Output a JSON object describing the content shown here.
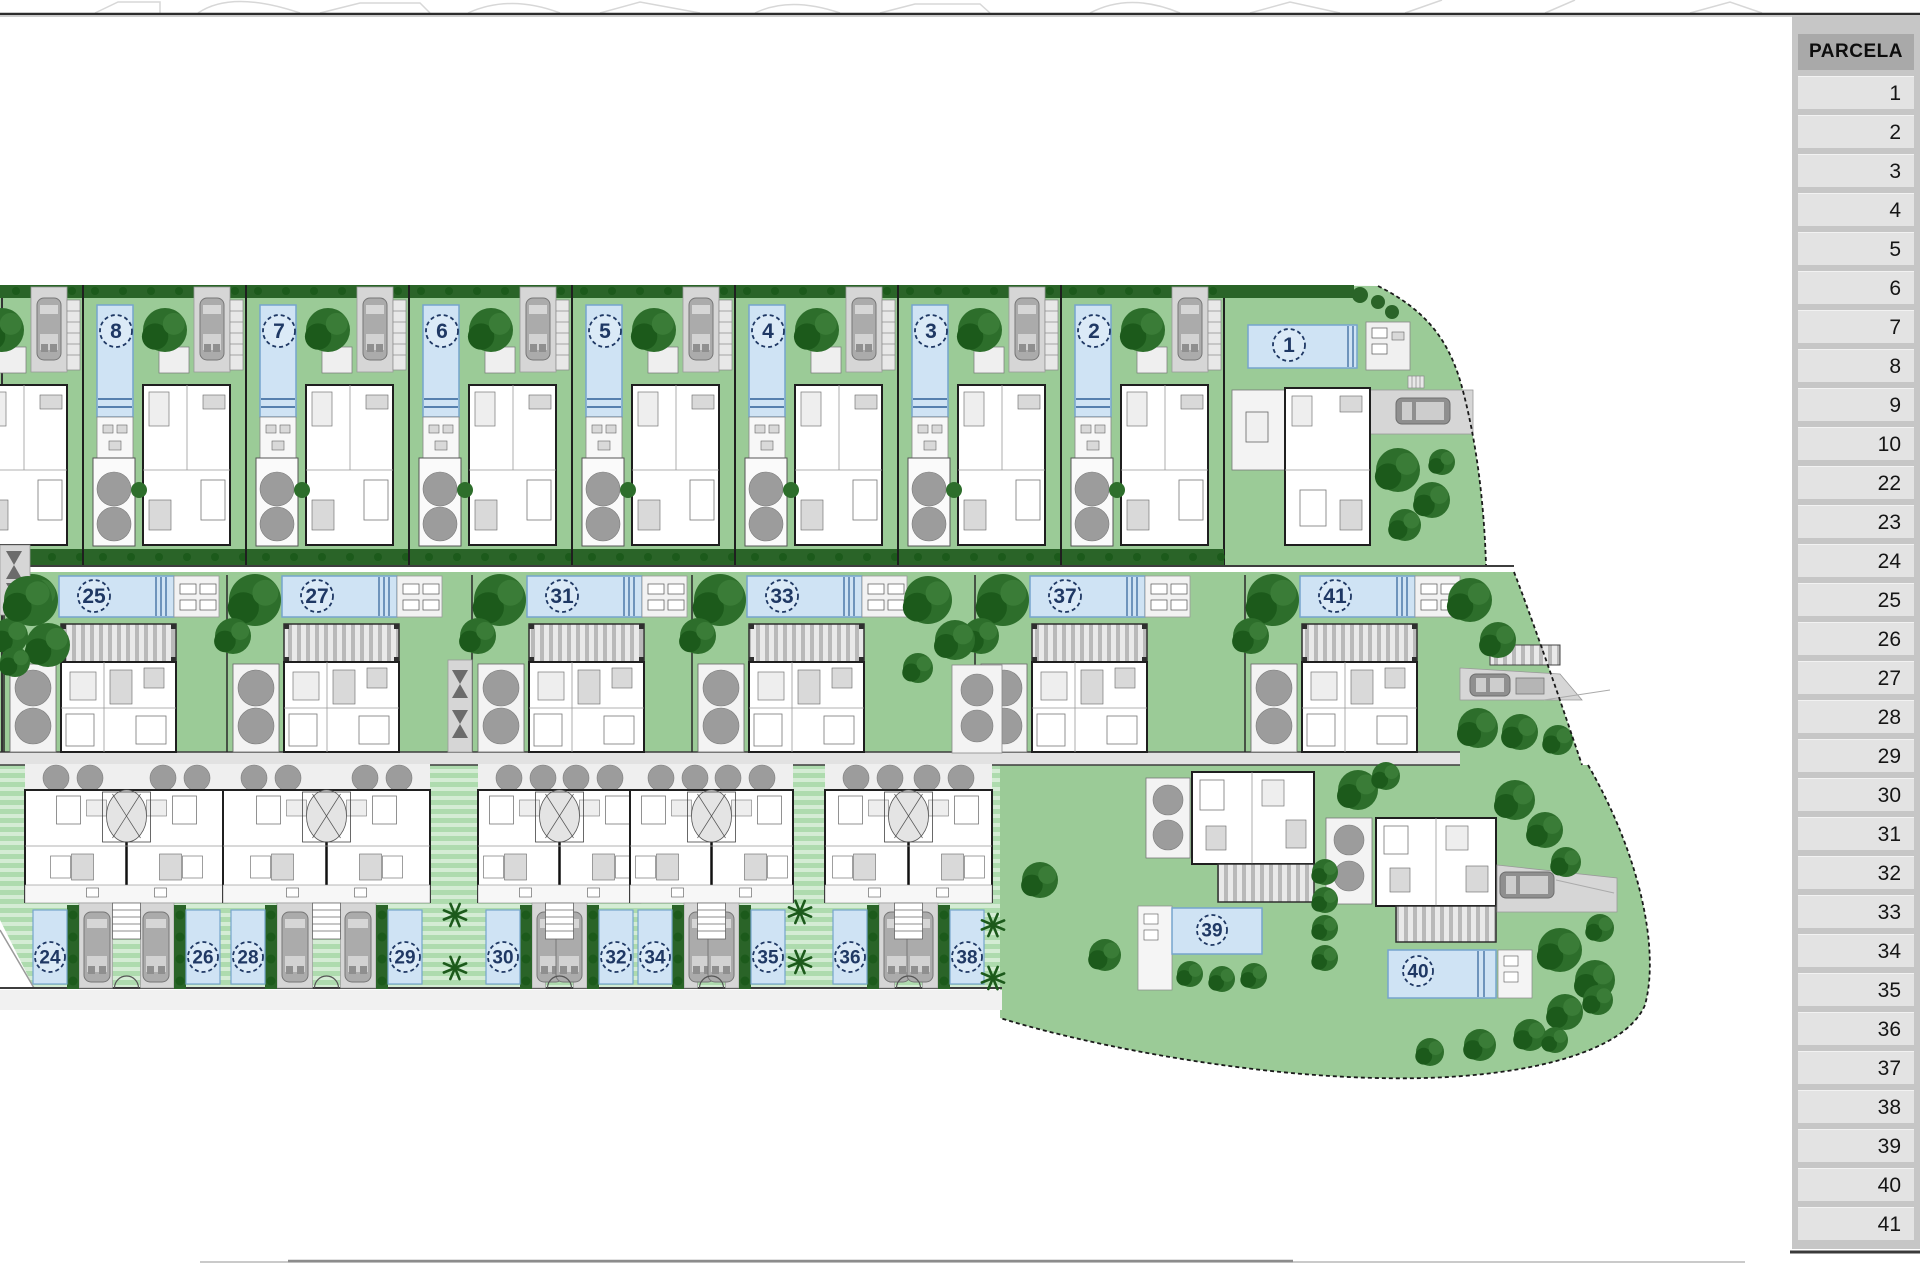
{
  "sidebar": {
    "header": "PARCELA",
    "rows": [
      "1",
      "2",
      "3",
      "4",
      "5",
      "6",
      "7",
      "8",
      "9",
      "10",
      "22",
      "23",
      "24",
      "25",
      "26",
      "27",
      "28",
      "29",
      "30",
      "31",
      "32",
      "33",
      "34",
      "35",
      "36",
      "37",
      "38",
      "39",
      "40",
      "41"
    ]
  },
  "plan": {
    "colors": {
      "lawn": "#9bcb97",
      "stripe_a": "#aedbae",
      "stripe_b": "#d4ecd4",
      "tree": "#2d6e2b",
      "tree_dark": "#1c5a1b",
      "hedge": "#2a6428",
      "pool": "#cfe3f4",
      "pool_edge": "#76a5cd",
      "pool_lane": "#2e5f96",
      "badge": "#1f3864",
      "drive": "#d6d6d6",
      "car": "#ababab",
      "car_dark": "#8f8f8f",
      "house_line": "#1f1f1f",
      "court": "#f3f3f3",
      "grey_tree": "#9c9c9c",
      "road_line": "#3d3d3d",
      "furn": "#d9d9d9",
      "pergola_a": "#e9e9e9",
      "pergola_b": "#b9b9b9"
    },
    "top_row": {
      "units": [
        {
          "n": "9",
          "x": -80
        },
        {
          "n": "8",
          "x": 83
        },
        {
          "n": "7",
          "x": 246
        },
        {
          "n": "6",
          "x": 409
        },
        {
          "n": "5",
          "x": 572
        },
        {
          "n": "4",
          "x": 735
        },
        {
          "n": "3",
          "x": 898
        },
        {
          "n": "2",
          "x": 1061
        }
      ]
    },
    "parcel_1": {
      "n": "1"
    },
    "middle_row": {
      "units": [
        {
          "n": "25",
          "x": 4
        },
        {
          "n": "27",
          "x": 227
        },
        {
          "n": "31",
          "x": 472
        },
        {
          "n": "33",
          "x": 692
        },
        {
          "n": "37",
          "x": 975
        },
        {
          "n": "41",
          "x": 1245
        }
      ]
    },
    "bottom_row": {
      "duplexes": [
        {
          "ln": "24",
          "lx": 50,
          "rn": "26",
          "rx": 203
        },
        {
          "ln": "28",
          "lx": 248,
          "rn": "29",
          "rx": 405
        },
        {
          "ln": "30",
          "lx": 503,
          "rn": "32",
          "rx": 616
        },
        {
          "ln": "34",
          "lx": 655,
          "rn": "35",
          "rx": 768
        },
        {
          "ln": "36",
          "lx": 850,
          "rn": "38",
          "rx": 967
        }
      ]
    },
    "villas": [
      {
        "n": "39"
      },
      {
        "n": "40"
      }
    ]
  }
}
